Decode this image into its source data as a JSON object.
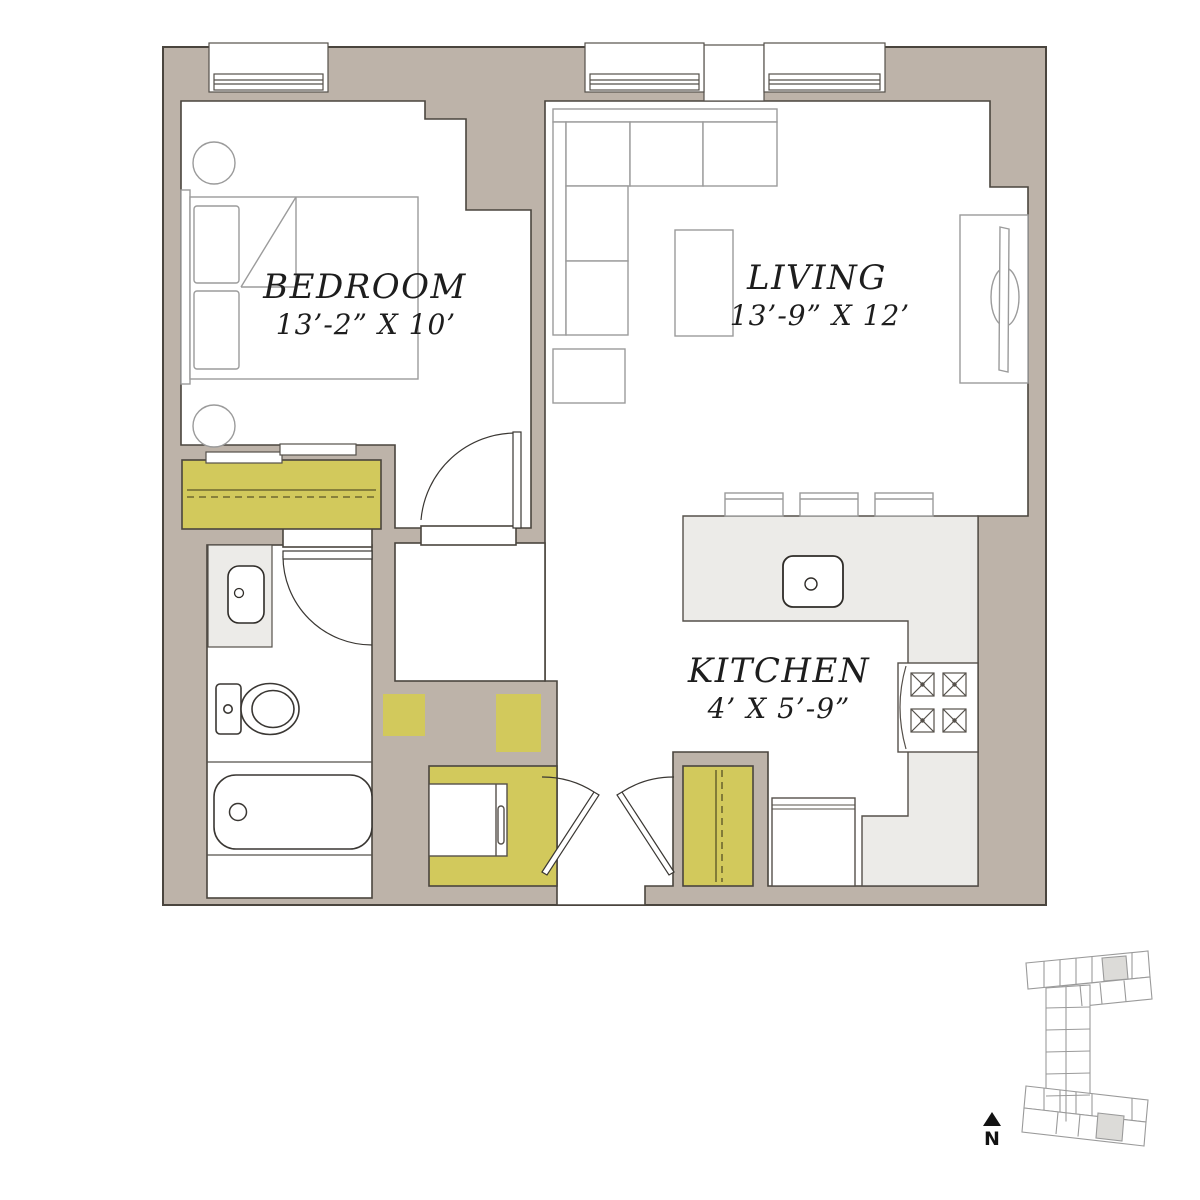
{
  "plan": {
    "rooms": [
      {
        "name": "BEDROOM",
        "dimensions": "13’-2” X 10’"
      },
      {
        "name": "LIVING",
        "dimensions": "13’-9” X 12’"
      },
      {
        "name": "KITCHEN",
        "dimensions": "4’ X 5’-9”"
      }
    ],
    "north": {
      "label": "N"
    },
    "colors": {
      "wall": "#bdb3a9",
      "outline": "#4a453e",
      "yellow": "#d2c95c",
      "yellowline": "#6e6830",
      "counter": "#ecebe8",
      "furn": "#9b9b9b",
      "fixture": "#55504a",
      "keyplan": "#9a9a9a",
      "highlight": "#dcdbd8"
    }
  }
}
